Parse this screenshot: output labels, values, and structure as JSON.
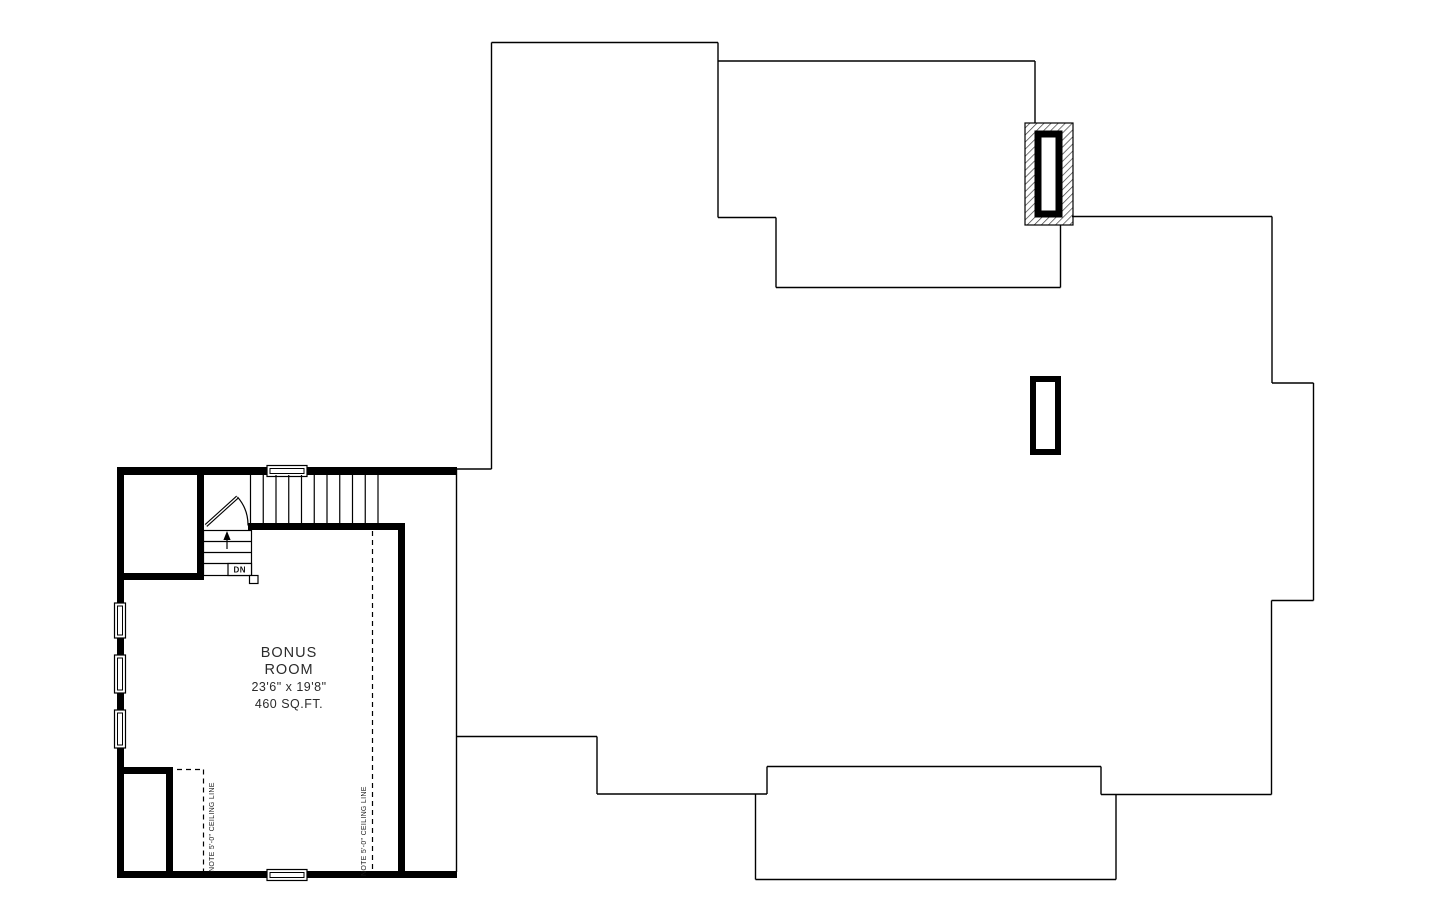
{
  "room": {
    "line1": "BONUS",
    "line2": "ROOM",
    "dimensions": "23'6\" x 19'8\"",
    "area": "460 SQ.FT."
  },
  "stairs": {
    "down_label": "DN"
  },
  "ceiling_notes": {
    "left": "NOTE 5'-0\" CEILING LINE",
    "right": "NOTE 5'-0\" CEILING LINE"
  },
  "colors": {
    "line": "#000000",
    "text": "#2b2b2b",
    "background": "#ffffff"
  }
}
